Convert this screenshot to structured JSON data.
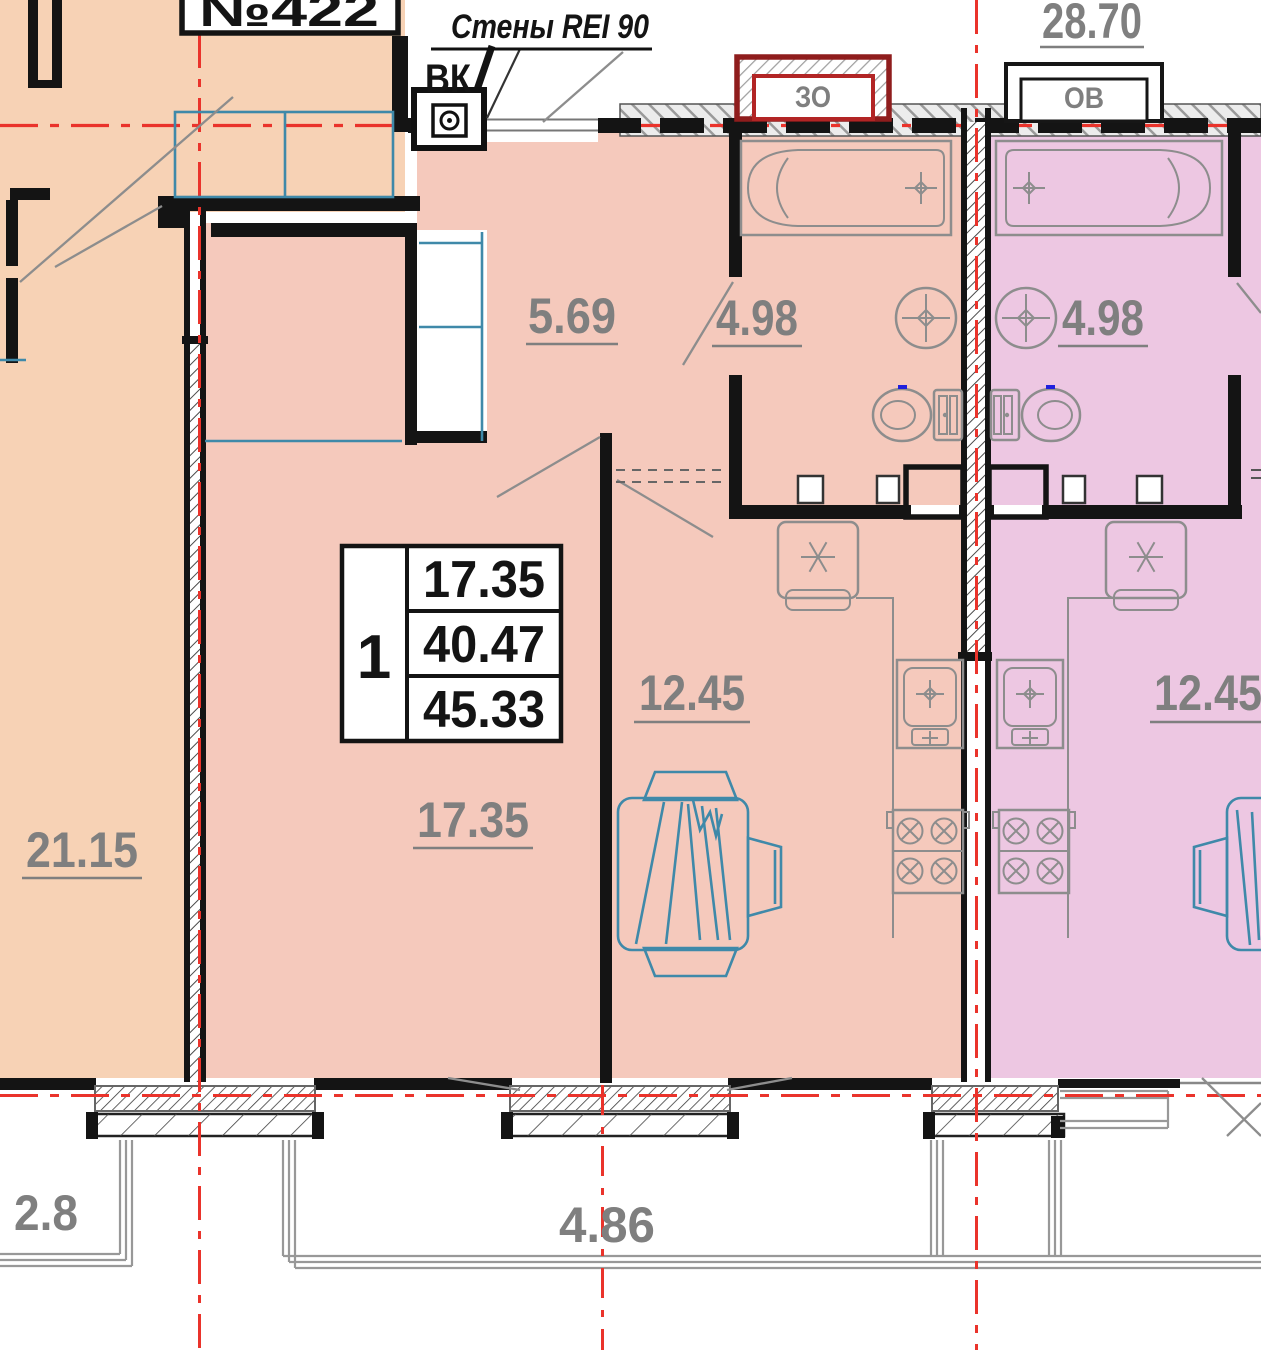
{
  "plate": {
    "number": "№422"
  },
  "notes": {
    "walls": "Стены REI 90"
  },
  "shafts": {
    "vk": "ВК",
    "zo": "ЗО",
    "ov": "ОВ"
  },
  "areas": {
    "upper_apartment": "28.70",
    "hallway": "5.69",
    "bathroom_left": "4.98",
    "bathroom_right": "4.98",
    "kitchen_living_left": "12.45",
    "kitchen_living_right": "12.45",
    "living_room": "17.35",
    "adjacent_room": "21.15"
  },
  "dimensions": {
    "balcony_left": "2.8",
    "balcony_center": "4.86"
  },
  "apartment_table": {
    "rooms": "1",
    "living_area": "17.35",
    "apartment_area": "40.47",
    "total_area": "45.33"
  },
  "colors": {
    "left_apartment_fill": "#f7d2b5",
    "center_apartment_fill": "#f5c9bc",
    "right_apartment_fill": "#edc7e2",
    "axis_red": "#ea332b",
    "wall_black": "#141414",
    "fixture_gray": "#8d8d8d",
    "label_gray": "#7f7f7f",
    "furniture_teal": "#3f89a9",
    "shaft_dark_red": "#8f1d1d"
  }
}
